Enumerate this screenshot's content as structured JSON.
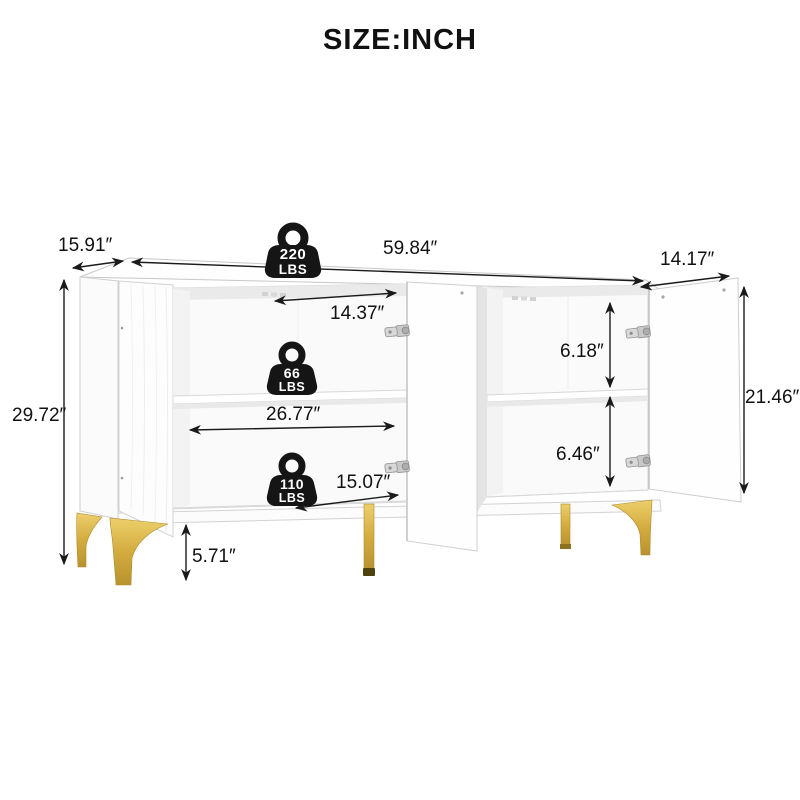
{
  "title": "SIZE:INCH",
  "dimensions": {
    "overall_depth": "15.91″",
    "overall_width": "59.84″",
    "door_width": "14.17″",
    "overall_height": "29.72″",
    "upper_opening_width": "14.37″",
    "shelf_width": "26.77″",
    "lower_opening_width": "15.07″",
    "upper_compartment_height": "6.18″",
    "lower_compartment_height": "6.46″",
    "side_interior_height": "21.46″",
    "leg_height": "5.71″"
  },
  "weight_capacities": {
    "top": {
      "value": "220",
      "unit": "LBS"
    },
    "shelf": {
      "value": "66",
      "unit": "LBS"
    },
    "bottom": {
      "value": "110",
      "unit": "LBS"
    }
  },
  "icons": {
    "weight_badge": "kettlebell-weight-icon"
  },
  "colors": {
    "background": "#ffffff",
    "cabinet_white": "#fefefe",
    "outline_gray": "#cccccc",
    "dimension_line": "#1a1a1a",
    "legs_gold": "#c9a13b",
    "badge_black": "#151515"
  }
}
